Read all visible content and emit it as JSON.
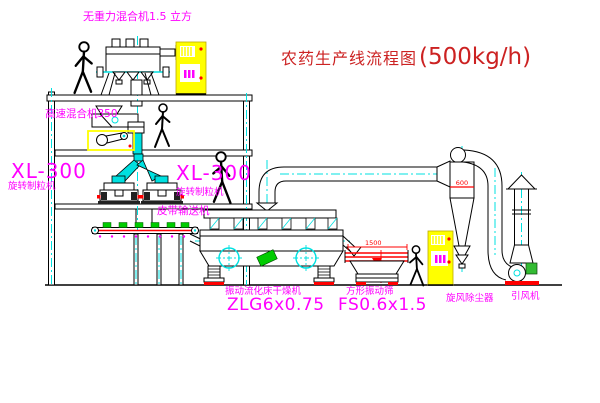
{
  "title": {
    "text": "农药生产线流程图",
    "capacity": "(500kg/h)"
  },
  "labels": {
    "gravity_mixer": "无重力混合机1.5 立方",
    "high_speed_mixer": "高速混合机350",
    "granulator_left_model": "XL-300",
    "granulator_left_name": "旋转制粒机",
    "granulator_right_model": "XL-300",
    "granulator_right_name": "旋转制粒机",
    "belt_conveyor": "皮带输送机",
    "dryer_name": "振动流化床干燥机",
    "dryer_model": "ZLG6x0.75",
    "screen_name": "方形振动筛",
    "screen_model": "FS0.6x1.5",
    "cyclone_name": "旋风除尘器",
    "fan_name": "引风机"
  },
  "dimensions": {
    "screen_length": "1500",
    "screen_height": "541",
    "cyclone_diameter": "600"
  },
  "colors": {
    "label_magenta": "#ff00ff",
    "title_red": "#cc2222",
    "line_black": "#000000",
    "centerline_cyan": "#00e0e0",
    "equipment_yellow": "#ffff00",
    "alert_red": "#ff0000",
    "material_green": "#00cc00"
  }
}
